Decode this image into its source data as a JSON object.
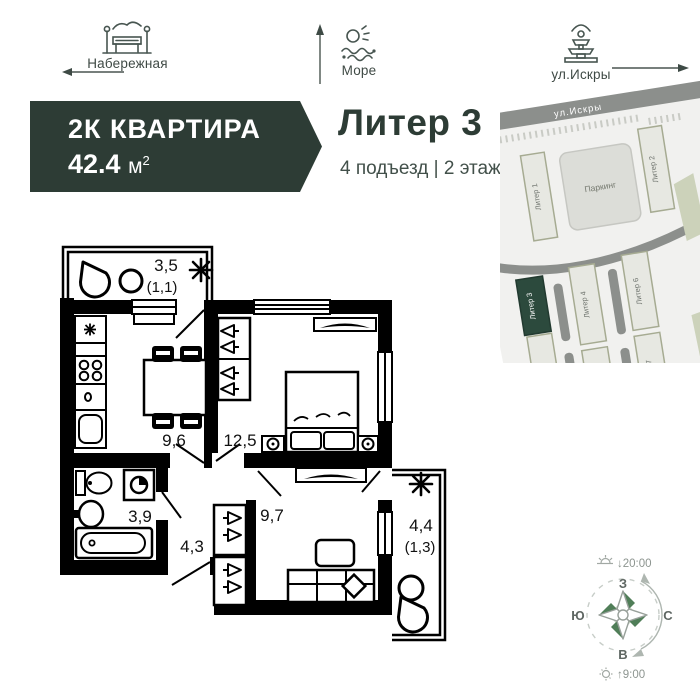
{
  "landmarks": {
    "embankment": {
      "label": "Набережная"
    },
    "sea": {
      "label": "Море"
    },
    "street": {
      "label": "ул.Искры"
    }
  },
  "apartment": {
    "type": "2К КВАРТИРА",
    "area": "42.4",
    "area_unit": "м",
    "area_sup": "2",
    "building": "Литер 3",
    "details": "4 подъезд | 2 этаж"
  },
  "site_map": {
    "street": "ул.Искры",
    "parking": "Паркинг",
    "liter1": "Литер 1",
    "liter2": "Литер 2",
    "liter3": "Литер 3",
    "liter4": "Литер 4",
    "liter5": "Литер 5",
    "liter6": "Литер 6",
    "liter7": "Литер 7"
  },
  "plan": {
    "rooms": {
      "balcony_top": {
        "area": "3,5",
        "reduced": "(1,1)"
      },
      "kitchen": {
        "area": "9,6"
      },
      "bedroom": {
        "area": "12,5"
      },
      "bathroom": {
        "area": "3,9"
      },
      "hallway": {
        "area": "4,3"
      },
      "living": {
        "area": "9,7"
      },
      "balcony_right": {
        "area": "4,4",
        "reduced": "(1,3)"
      }
    }
  },
  "compass": {
    "sunset": "↓20:00",
    "sunrise": "↑9:00",
    "top": "З",
    "left": "Ю",
    "right": "С",
    "bottom": "В"
  },
  "colors": {
    "banner": "#2d3c35",
    "map_highlight": "#2c4a3d",
    "compass_dark": "#507e58",
    "compass_light": "#cbd9c4"
  }
}
